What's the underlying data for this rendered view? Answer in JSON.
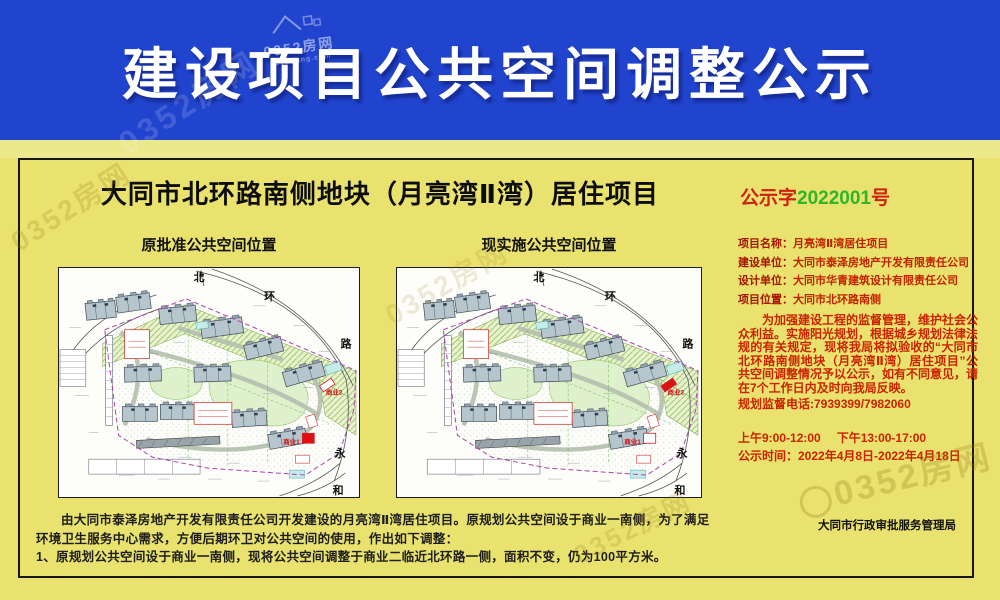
{
  "banner": {
    "title": "建设项目公共空间调整公示",
    "bg_color": "#2144ce",
    "text_color": "#ffffff"
  },
  "watermark": {
    "text": "0352房网",
    "domain": "0352.fang.com"
  },
  "notice": {
    "title": "大同市北环路南侧地块（月亮湾Ⅱ湾）居住项目",
    "doc_no": {
      "prefix": "公示字",
      "number": "2022001",
      "suffix": "号",
      "prefix_color": "#cc2211",
      "number_color": "#2fb52a"
    },
    "maps": {
      "left_label": "原批准公共空间位置",
      "right_label": "现实施公共空间位置",
      "street_labels": {
        "north": "北",
        "ring": "环",
        "road": "路",
        "yong": "永",
        "he": "和"
      },
      "biz1_label": "商业1",
      "biz2_label": "商业2",
      "marker_color": "#dd1111",
      "marker_old": {
        "x": 245,
        "y": 166,
        "w": 12,
        "h": 10,
        "rot": 0
      },
      "marker_new": {
        "x": 263,
        "y": 114,
        "w": 14,
        "h": 7,
        "rot": -34
      }
    },
    "info": [
      {
        "label": "项目名称：",
        "value": "月亮湾Ⅱ湾居住项目"
      },
      {
        "label": "建设单位：",
        "value": "大同市泰泽房地产开发有限责任公司"
      },
      {
        "label": "设计单位：",
        "value": "大同市华青建筑设计有限责任公司"
      },
      {
        "label": "项目位置：",
        "value": "大同市北环路南侧"
      }
    ],
    "body": "为加强建设工程的监督管理，维护社会公众利益。实施阳光规划，根据城乡规划法律法规的有关规定，现将我局将拟验收的“大同市北环路南侧地块（月亮湾Ⅱ湾）居住项目”公共空间调整情况予以公示，如有不同意见，请在7个工作日内及时向我局反映。",
    "phone_line": "规划监督电话:7939399/7982060",
    "hours_am": "上午9:00-12:00",
    "hours_pm": "下午13:00-17:00",
    "period": "公示时间：2022年4月8日-2022年4月18日",
    "bottom_para1": "由大同市泰泽房地产开发有限责任公司开发建设的月亮湾Ⅱ湾居住项目。原规划公共空间设于商业一南侧，为了满足环境卫生服务中心需求，方便后期环卫对公共空间的使用，作出如下调整：",
    "bottom_para2": "1、原规划公共空间设于商业一南侧，现将公共空间调整于商业二临近北环路一侧，面积不变，仍为100平方米。",
    "agency": "大同市行政审批服务管理局"
  }
}
